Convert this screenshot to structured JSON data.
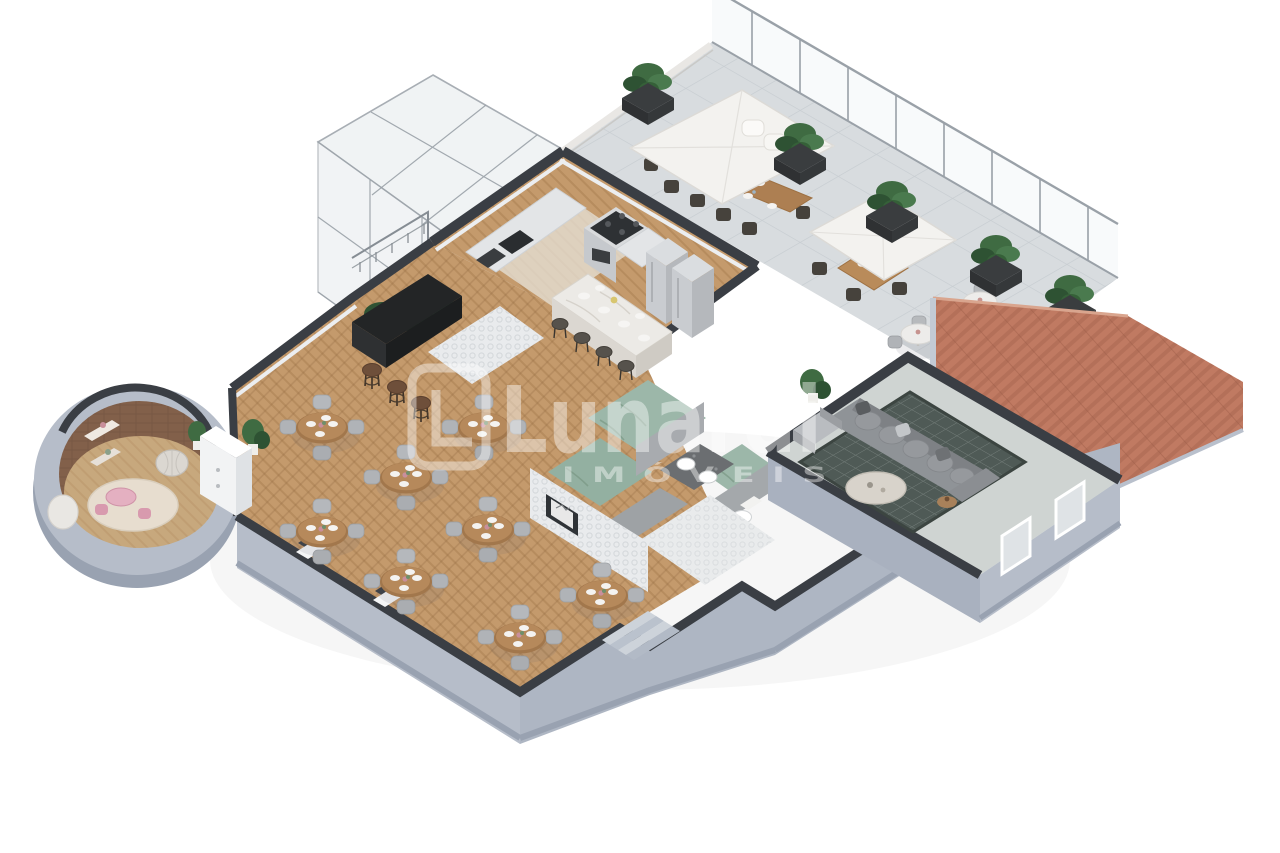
{
  "page": {
    "background": "#ffffff",
    "description": "Isometric 3D cutaway render of a restaurant floor plan"
  },
  "watermark": {
    "brand": "Lunardi",
    "subtitle": "IMÓVEIS",
    "registered": "®",
    "color": "#ffffff"
  },
  "palette": {
    "background": "#ffffff",
    "wall_dark": "#3a3e44",
    "wall_inner": "#eceef0",
    "wall_exterior": "#b6bdc9",
    "wall_exterior_shadow": "#99a2b1",
    "wood_floor": "#c49a6c",
    "terrace_tile": "#d8dcdf",
    "glass": "#eef1f3",
    "glass_frame": "#9aa1a8",
    "roof": "#c07a62",
    "roof_gutter": "#c3cad4",
    "plant_green": "#3f6b42",
    "planter_dark": "#3a3d3f",
    "table_wood": "#ad7f52",
    "chair_gray": "#b5b8bc",
    "chair_dark": "#46423c",
    "umbrella_white": "#f3f2ef",
    "marble": "#eceae6",
    "steel": "#c9ccd0",
    "sofa_gray": "#8f9397",
    "rug_dark": "#4f5a56",
    "moss_green": "#9cb7a9",
    "concrete": "#a8abaf",
    "tile_white": "#e9ebec",
    "brick_brown": "#82604a",
    "kids_pink": "#e4b0c1",
    "rug_cream": "#e7ddcf"
  },
  "scene": {
    "areas": [
      {
        "id": "glass-stairwell",
        "label": "glass stairwell enclosure"
      },
      {
        "id": "rooftop-terrace",
        "label": "rooftop terrace dining"
      },
      {
        "id": "kitchen",
        "label": "kitchen with island"
      },
      {
        "id": "dining-hall",
        "label": "dining hall"
      },
      {
        "id": "kids-room",
        "label": "round kids playroom"
      },
      {
        "id": "bar",
        "label": "bar counter"
      },
      {
        "id": "restrooms",
        "label": "restrooms"
      },
      {
        "id": "lounge",
        "label": "lounge"
      },
      {
        "id": "tiled-roof",
        "label": "terracotta tiled roof"
      }
    ],
    "dining_tables": [
      [
        322,
        428
      ],
      [
        406,
        478
      ],
      [
        484,
        428
      ],
      [
        488,
        530
      ],
      [
        322,
        532
      ],
      [
        406,
        582
      ],
      [
        520,
        638
      ],
      [
        602,
        596
      ]
    ],
    "terrace_planters": [
      [
        648,
        92
      ],
      [
        800,
        152
      ],
      [
        892,
        210
      ],
      [
        996,
        264
      ],
      [
        1070,
        304
      ]
    ],
    "terrace_bistro_tables": [
      [
        918,
        338
      ],
      [
        980,
        306
      ]
    ],
    "bar_stools": [
      [
        372,
        366
      ],
      [
        397,
        383
      ],
      [
        421,
        399
      ]
    ],
    "island_stools": [
      [
        560,
        322
      ],
      [
        582,
        336
      ],
      [
        604,
        350
      ],
      [
        626,
        364
      ]
    ]
  }
}
